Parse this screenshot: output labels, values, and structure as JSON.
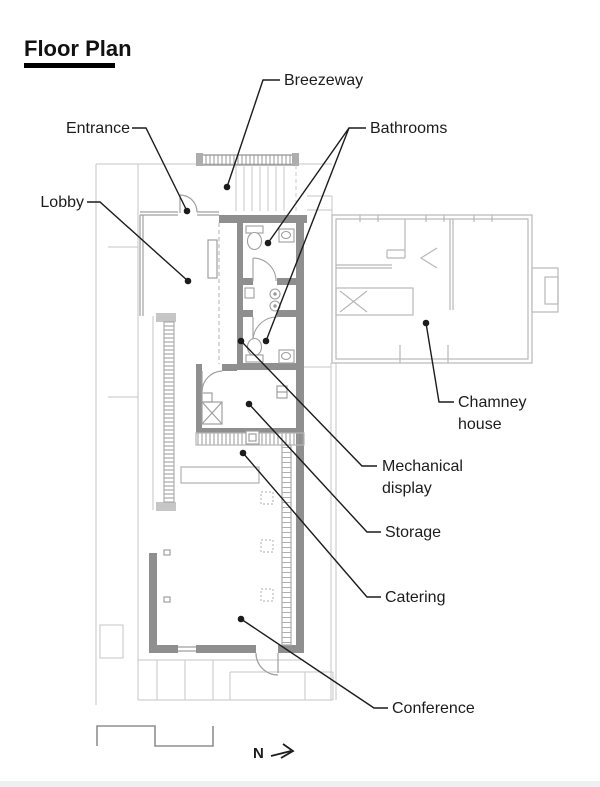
{
  "title": "Floor Plan",
  "labels": {
    "breezeway": "Breezeway",
    "entrance": "Entrance",
    "lobby": "Lobby",
    "bathrooms": "Bathrooms",
    "chamney_house_line1": "Chamney",
    "chamney_house_line2": "house",
    "mechanical_display_line1": "Mechanical",
    "mechanical_display_line2": "display",
    "storage": "Storage",
    "catering": "Catering",
    "conference": "Conference"
  },
  "compass": {
    "north_label": "N",
    "direction": "right"
  },
  "colors": {
    "label_text": "#1c1c1c",
    "leader_line": "#1c1c1c",
    "wall_fill": "#8f8f8f",
    "thin_line": "#9f9f9f",
    "site_line": "#c5c5c5",
    "house_line": "#b8b8b8",
    "title_underline": "#000000"
  }
}
